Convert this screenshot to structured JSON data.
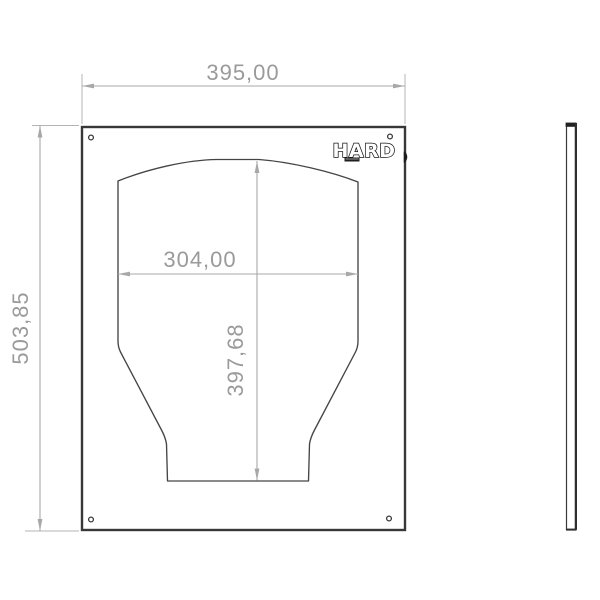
{
  "drawing": {
    "front_view": {
      "logo_text": "HARD"
    },
    "dimensions": {
      "overall_width": "395,00",
      "overall_height": "503,85",
      "cutout_width": "304,00",
      "cutout_height": "397,68"
    },
    "colors": {
      "part_outline": "#383838",
      "cutout_outline": "#454545",
      "dimension_line": "#a8a8a8",
      "extension_line": "#b4b4b4",
      "dimension_text": "#9a9a9a",
      "background": "#ffffff"
    }
  }
}
